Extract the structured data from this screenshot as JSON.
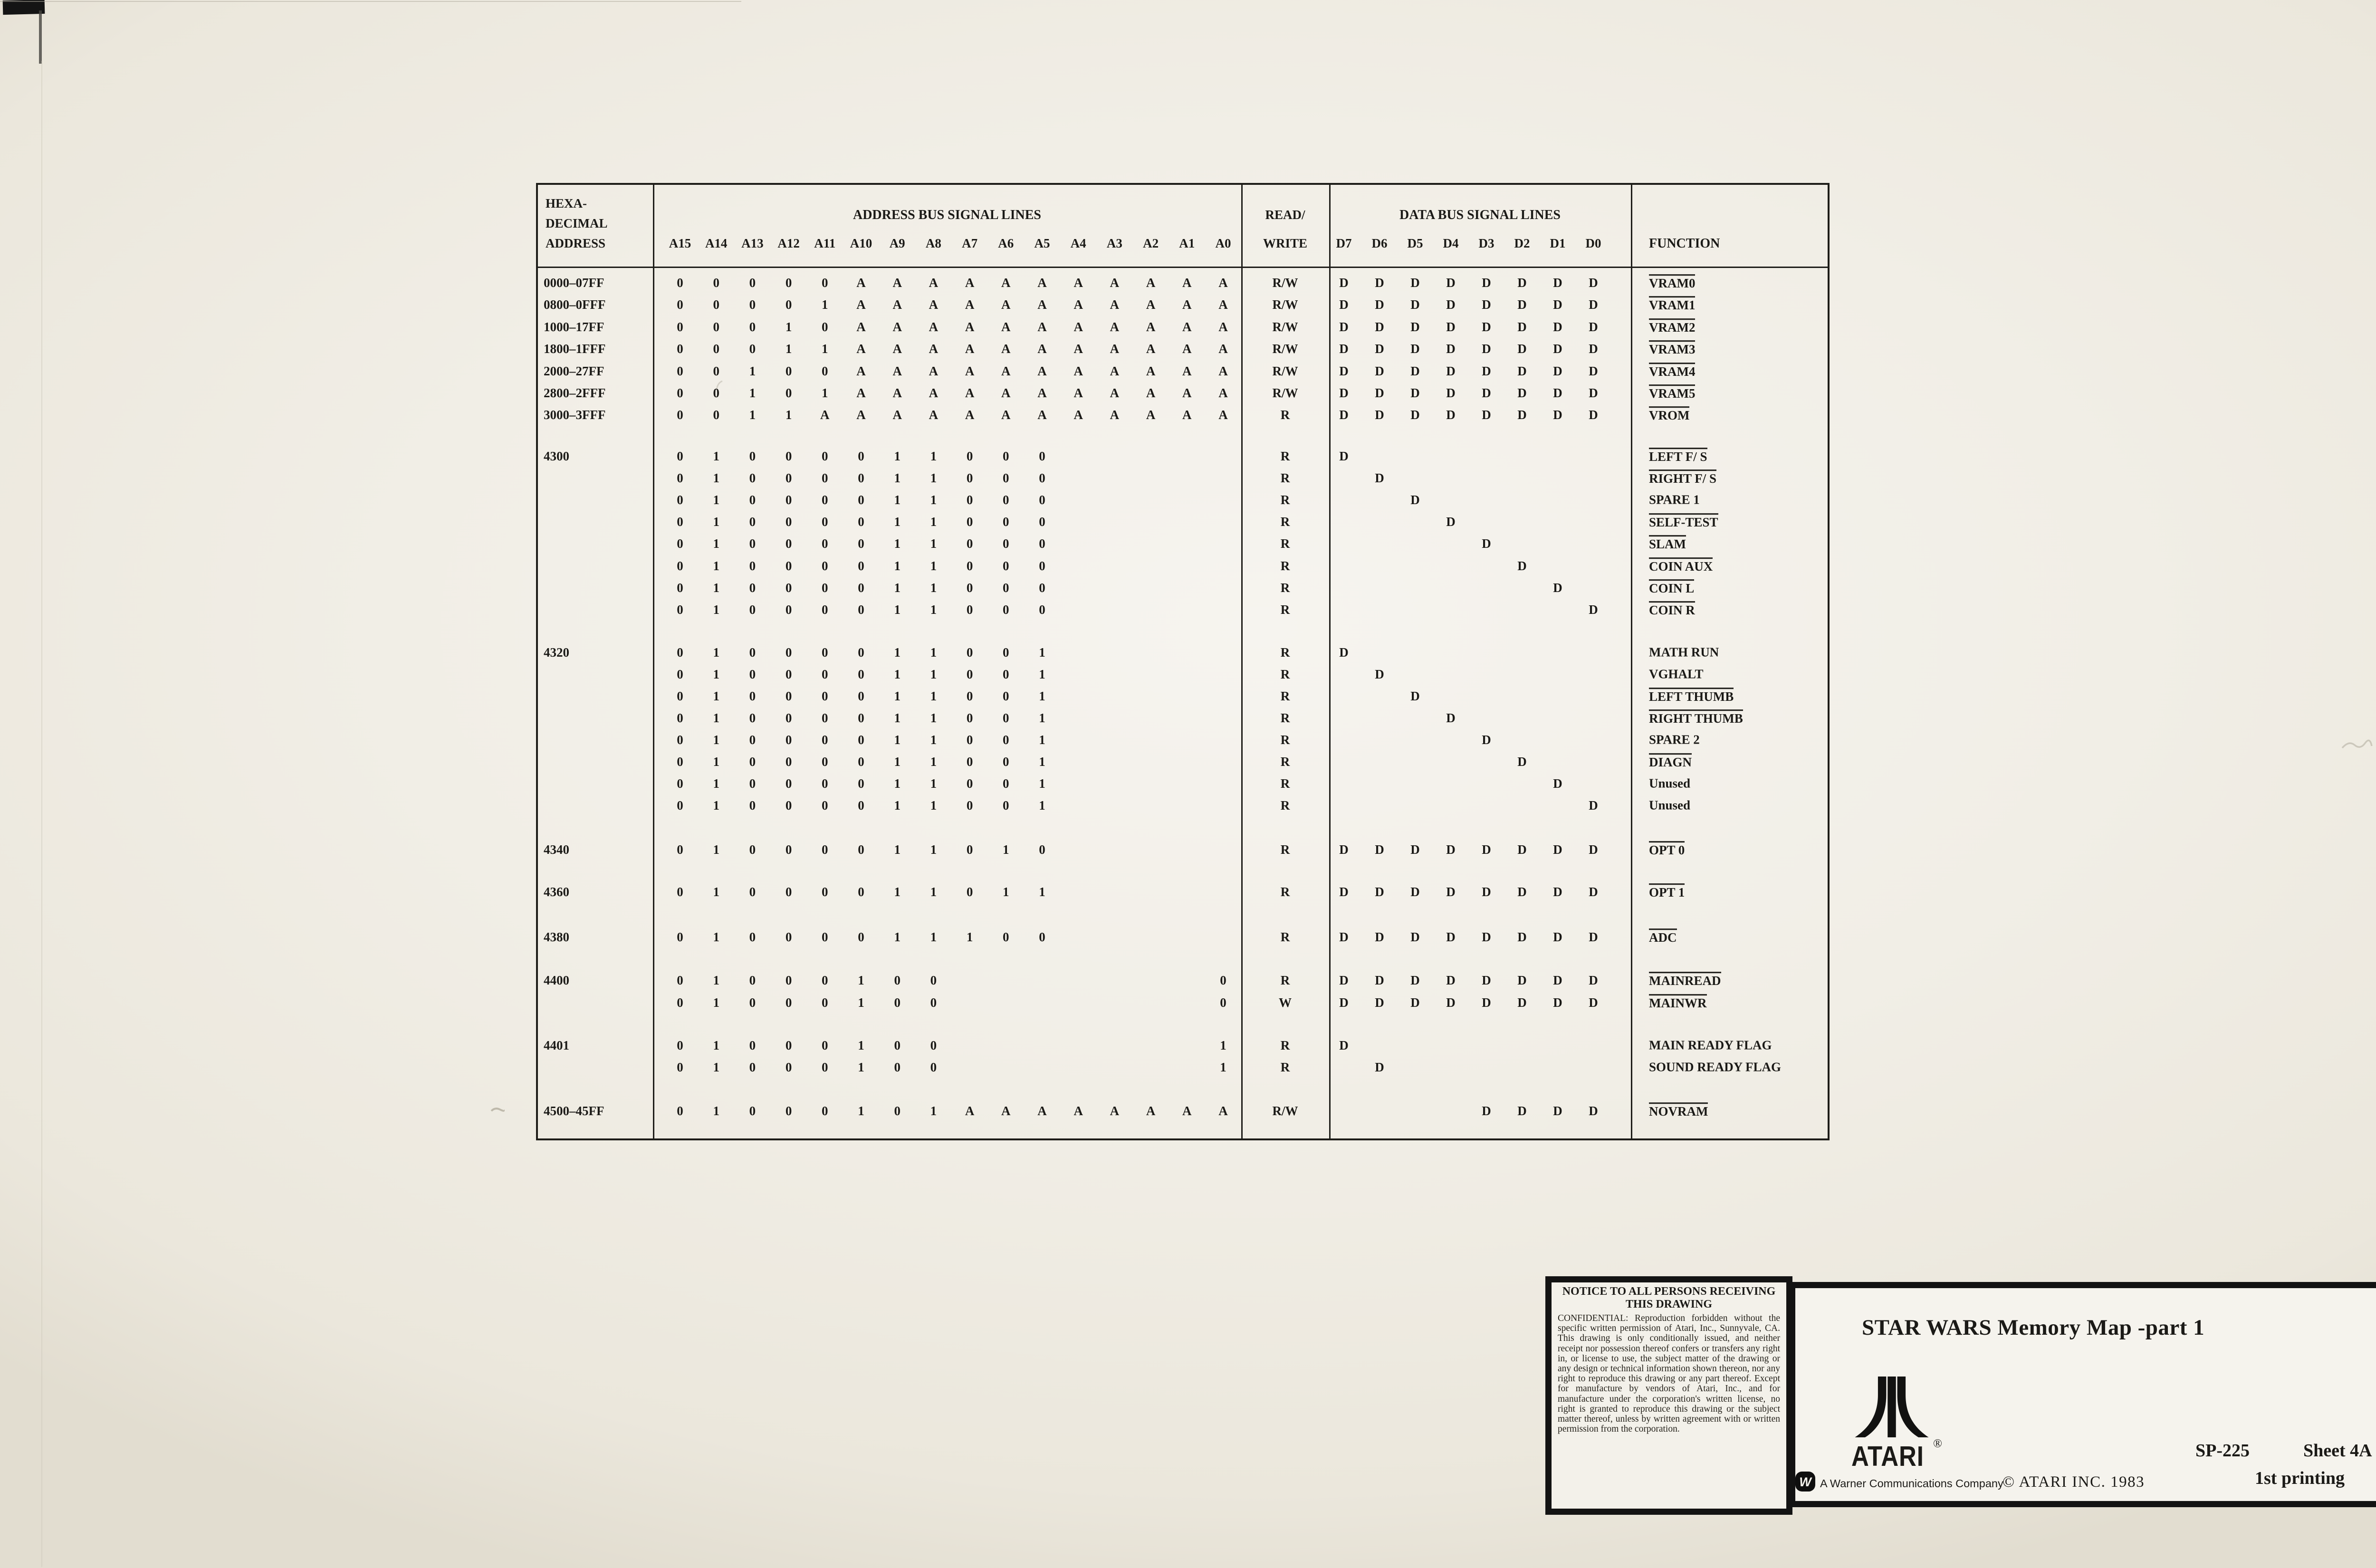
{
  "sheet": {
    "paper_color": "#f1eee6",
    "ink_color": "#1e1d19"
  },
  "table": {
    "col1_lines": [
      "HEXA-",
      "DECIMAL",
      "ADDRESS"
    ],
    "address_section_title": "ADDRESS BUS SIGNAL LINES",
    "address_bit_labels": [
      "A15",
      "A14",
      "A13",
      "A12",
      "A11",
      "A10",
      "A9",
      "A8",
      "A7",
      "A6",
      "A5",
      "A4",
      "A3",
      "A2",
      "A1",
      "A0"
    ],
    "rw_lines": [
      "READ/",
      "WRITE"
    ],
    "data_section_title": "DATA BUS SIGNAL LINES",
    "data_bit_labels": [
      "D7",
      "D6",
      "D5",
      "D4",
      "D3",
      "D2",
      "D1",
      "D0"
    ],
    "function_header": "FUNCTION",
    "groups": [
      {
        "rows": [
          {
            "addr": "0000–07FF",
            "a": "00000AAAAAAAAAAA",
            "rw": "R/W",
            "d": "DDDDDDDD",
            "fn": "VRAM0",
            "ol": true
          },
          {
            "addr": "0800–0FFF",
            "a": "00001AAAAAAAAAAA",
            "rw": "R/W",
            "d": "DDDDDDDD",
            "fn": "VRAM1",
            "ol": true
          },
          {
            "addr": "1000–17FF",
            "a": "00010AAAAAAAAAAA",
            "rw": "R/W",
            "d": "DDDDDDDD",
            "fn": "VRAM2",
            "ol": true
          },
          {
            "addr": "1800–1FFF",
            "a": "00011AAAAAAAAAAA",
            "rw": "R/W",
            "d": "DDDDDDDD",
            "fn": "VRAM3",
            "ol": true
          },
          {
            "addr": "2000–27FF",
            "a": "00100AAAAAAAAAAA",
            "rw": "R/W",
            "d": "DDDDDDDD",
            "fn": "VRAM4",
            "ol": true
          },
          {
            "addr": "2800–2FFF",
            "a": "00101AAAAAAAAAAA",
            "rw": "R/W",
            "d": "DDDDDDDD",
            "fn": "VRAM5",
            "ol": true
          },
          {
            "addr": "3000–3FFF",
            "a": "0011AAAAAAAAAAAA",
            "rw": "R",
            "d": "DDDDDDDD",
            "fn": "VROM",
            "ol": true
          }
        ]
      },
      {
        "rows": [
          {
            "addr": "4300",
            "a": "01000011000.....",
            "rw": "R",
            "d": "D.......",
            "fn": "LEFT F/ S",
            "ol": true
          },
          {
            "a": "01000011000.....",
            "rw": "R",
            "d": ".D......",
            "fn": "RIGHT F/ S",
            "ol": true
          },
          {
            "a": "01000011000.....",
            "rw": "R",
            "d": "..D.....",
            "fn": "SPARE 1",
            "ol": false
          },
          {
            "a": "01000011000.....",
            "rw": "R",
            "d": "...D....",
            "fn": "SELF-TEST",
            "ol": true
          },
          {
            "a": "01000011000.....",
            "rw": "R",
            "d": "....D...",
            "fn": "SLAM",
            "ol": true
          },
          {
            "a": "01000011000.....",
            "rw": "R",
            "d": ".....D..",
            "fn": "COIN AUX",
            "ol": true
          },
          {
            "a": "01000011000.....",
            "rw": "R",
            "d": "......D.",
            "fn": "COIN L",
            "ol": true
          },
          {
            "a": "01000011000.....",
            "rw": "R",
            "d": ".......D",
            "fn": "COIN R",
            "ol": true
          }
        ]
      },
      {
        "rows": [
          {
            "addr": "4320",
            "a": "01000011001.....",
            "rw": "R",
            "d": "D.......",
            "fn": "MATH RUN",
            "ol": false
          },
          {
            "a": "01000011001.....",
            "rw": "R",
            "d": ".D......",
            "fn": "VGHALT",
            "ol": false
          },
          {
            "a": "01000011001.....",
            "rw": "R",
            "d": "..D.....",
            "fn": "LEFT THUMB",
            "ol": true
          },
          {
            "a": "01000011001.....",
            "rw": "R",
            "d": "...D....",
            "fn": "RIGHT THUMB",
            "ol": true
          },
          {
            "a": "01000011001.....",
            "rw": "R",
            "d": "....D...",
            "fn": "SPARE 2",
            "ol": false
          },
          {
            "a": "01000011001.....",
            "rw": "R",
            "d": ".....D..",
            "fn": "DIAGN",
            "ol": true
          },
          {
            "a": "01000011001.....",
            "rw": "R",
            "d": "......D.",
            "fn": "Unused",
            "ol": false
          },
          {
            "a": "01000011001.....",
            "rw": "R",
            "d": ".......D",
            "fn": "Unused",
            "ol": false
          }
        ]
      },
      {
        "rows": [
          {
            "addr": "4340",
            "a": "01000011010.....",
            "rw": "R",
            "d": "DDDDDDDD",
            "fn": "OPT 0",
            "ol": true
          }
        ]
      },
      {
        "rows": [
          {
            "addr": "4360",
            "a": "01000011011.....",
            "rw": "R",
            "d": "DDDDDDDD",
            "fn": "OPT 1",
            "ol": true
          }
        ]
      },
      {
        "rows": [
          {
            "addr": "4380",
            "a": "01000011100.....",
            "rw": "R",
            "d": "DDDDDDDD",
            "fn": "ADC",
            "ol": true
          }
        ]
      },
      {
        "rows": [
          {
            "addr": "4400",
            "a": "01000100.......0",
            "rw": "R",
            "d": "DDDDDDDD",
            "fn": "MAINREAD",
            "ol": true
          },
          {
            "a": "01000100.......0",
            "rw": "W",
            "d": "DDDDDDDD",
            "fn": "MAINWR",
            "ol": true
          }
        ]
      },
      {
        "rows": [
          {
            "addr": "4401",
            "a": "01000100.......1",
            "rw": "R",
            "d": "D.......",
            "fn": "MAIN READY FLAG",
            "ol": false
          },
          {
            "a": "01000100.......1",
            "rw": "R",
            "d": ".D......",
            "fn": "SOUND READY FLAG",
            "ol": false
          }
        ]
      },
      {
        "rows": [
          {
            "addr": "4500–45FF",
            "a": "01000101AAAAAAAA",
            "rw": "R/W",
            "d": "....DDDD",
            "fn": "NOVRAM",
            "ol": true
          }
        ]
      }
    ]
  },
  "notice": {
    "title1": "NOTICE TO ALL PERSONS RECEIVING",
    "title2": "THIS DRAWING",
    "body": "CONFIDENTIAL: Reproduction forbidden without the specific written permission of Atari, Inc., Sunnyvale, CA. This drawing is only conditionally issued, and neither receipt nor possession thereof confers or transfers any right in, or license to use, the subject matter of the drawing or any design or technical information shown thereon, nor any right to reproduce this drawing or any part thereof. Except for manufacture by vendors of Atari, Inc., and for manufacture under the corporation's written license, no right is granted to reproduce this drawing or the subject matter thereof, unless by written agreement with or written permission from the corporation."
  },
  "title_block": {
    "title": "STAR WARS Memory Map -part 1",
    "brand": "ATARI",
    "registered": "®",
    "warner_line": "A Warner Communications Company",
    "warner_logo_letter": "W",
    "copyright": "© ATARI INC. 1983",
    "doc_number": "SP-225",
    "sheet": "Sheet 4A",
    "printing": "1st printing"
  }
}
